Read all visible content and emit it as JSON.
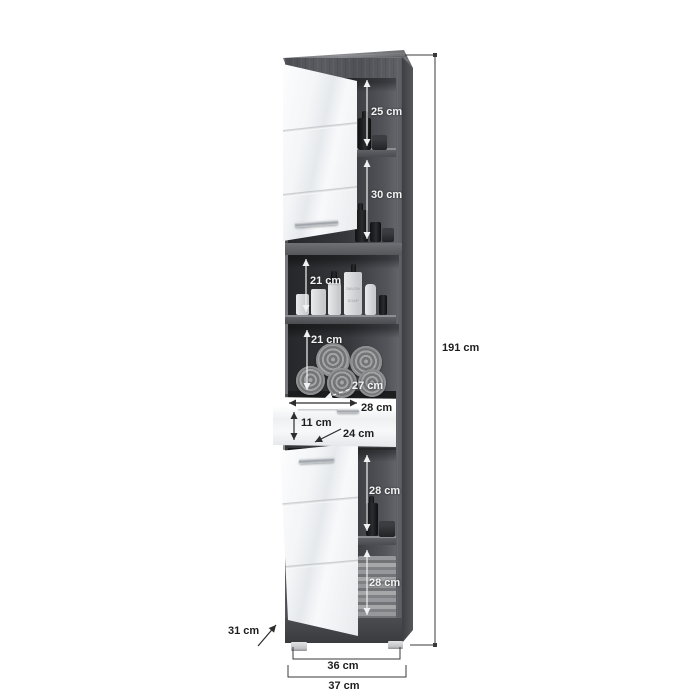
{
  "scene": {
    "background": "#ffffff"
  },
  "cabinet": {
    "type": "tall-bathroom-cabinet-diagram",
    "colors": {
      "carcass": "#54555a",
      "top_panel": "#7d7e82",
      "interior": "#37383c",
      "door": "#f3f5f7",
      "handle": "#b4b8bd",
      "towel": "#94959a",
      "feet": "#d4d5d8",
      "dimension_line_dark": "#333333",
      "dimension_line_light": "#f2f2f2"
    },
    "soap_dispenser": {
      "line1": "SAVON",
      "line2": "SOAP"
    }
  },
  "annotations": {
    "height_total": "191 cm",
    "width_inner": "36 cm",
    "width_total": "37 cm",
    "depth_total": "31 cm",
    "top_compartment_height": "25 cm",
    "second_compartment_height": "30 cm",
    "open_shelf_1_height": "21 cm",
    "open_shelf_2_height": "21 cm",
    "shelf_depth": "27 cm",
    "drawer_width": "28 cm",
    "drawer_front_height": "11 cm",
    "drawer_depth": "24 cm",
    "lower_compartment_1_height": "28 cm",
    "lower_compartment_2_height": "28 cm"
  }
}
